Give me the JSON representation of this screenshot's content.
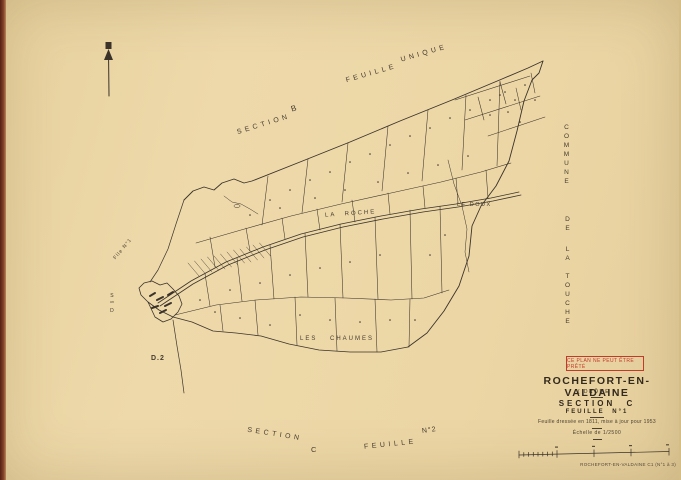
{
  "neighbors": {
    "section_b": {
      "word": "SECTION",
      "letter": "B"
    },
    "feuille_unique": {
      "word1": "FEUILLE",
      "word2": "UNIQUE"
    },
    "commune": {
      "word1": "COMMUNE",
      "word2": "DE",
      "word3": "LA TOUCHE"
    },
    "flle_n1": "Flle N°1",
    "son_d": {
      "l1": "S",
      "l2": "on",
      "l3": "D"
    },
    "bottom": {
      "word1": "SECTION",
      "word2": "C",
      "word3": "FEUILLE",
      "word4": "N°2"
    }
  },
  "places": {
    "la_roche": "LA ROCHE",
    "le_doux": "LE DOUX",
    "les_chaumes": "LES CHAUMES",
    "d2": "D.2"
  },
  "title_block": {
    "stamp": "CE PLAN NE PEUT ÊTRE PRÊTÉ",
    "commune": "ROCHEFORT-EN-VALDAINE",
    "departement": "( DRÔME )",
    "section": "SECTION C",
    "feuille": "FEUILLE N°1",
    "revision_note": "Feuille dressée en 1811, mise à jour pour 1953",
    "scale": "Échelle de 1/2500",
    "footer_ref": "ROCHEFORT-EN-VALDAINE C1 (N°1 à 3)"
  },
  "colors": {
    "paper": "#ecd7a6",
    "ink": "#3b332a",
    "stamp_red": "#c23b2a",
    "edge_strip": "#6e2b1e"
  }
}
